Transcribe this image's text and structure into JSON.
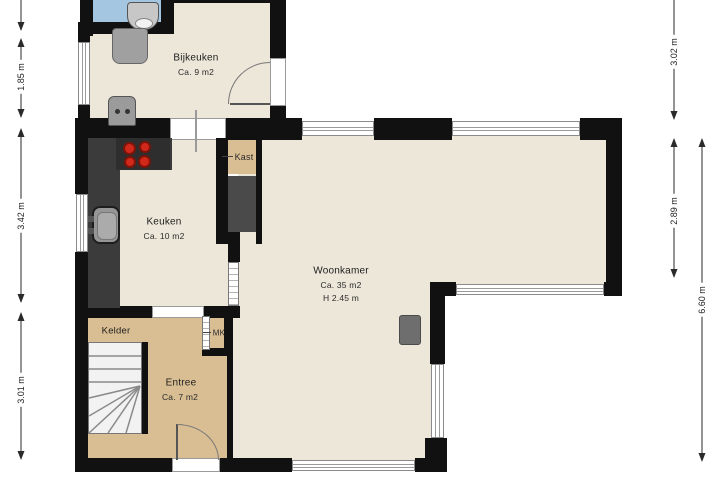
{
  "rooms": {
    "bijkeuken": {
      "name": "Bijkeuken",
      "area": "Ca. 9 m2"
    },
    "keuken": {
      "name": "Keuken",
      "area": "Ca. 10 m2"
    },
    "kast": {
      "name": "Kast"
    },
    "woonkamer": {
      "name": "Woonkamer",
      "area": "Ca. 35 m2",
      "height": "H 2.45 m"
    },
    "kelder": {
      "name": "Kelder"
    },
    "entree": {
      "name": "Entree",
      "area": "Ca. 7 m2"
    },
    "mk": {
      "name": "MK"
    }
  },
  "dimensions": {
    "left": [
      {
        "label": "1.85 m"
      },
      {
        "label": "3.42 m"
      },
      {
        "label": "3.01 m"
      }
    ],
    "right": [
      {
        "label": "3.02 m"
      },
      {
        "label": "2.89 m"
      },
      {
        "label": "6.60 m"
      }
    ]
  },
  "colors": {
    "wall": "#111111",
    "floor": "#EDE7DA",
    "floor_entree": "#D9BE93",
    "room_blue": "#A5C6E1",
    "counter": "#3B3B3B",
    "cabinet_dark": "#4A4A4A",
    "burner_red": "#D0281A",
    "appliance_gray": "#A0A0A0",
    "dimension": "#2A2A2A",
    "background": "#FFFFFF"
  }
}
